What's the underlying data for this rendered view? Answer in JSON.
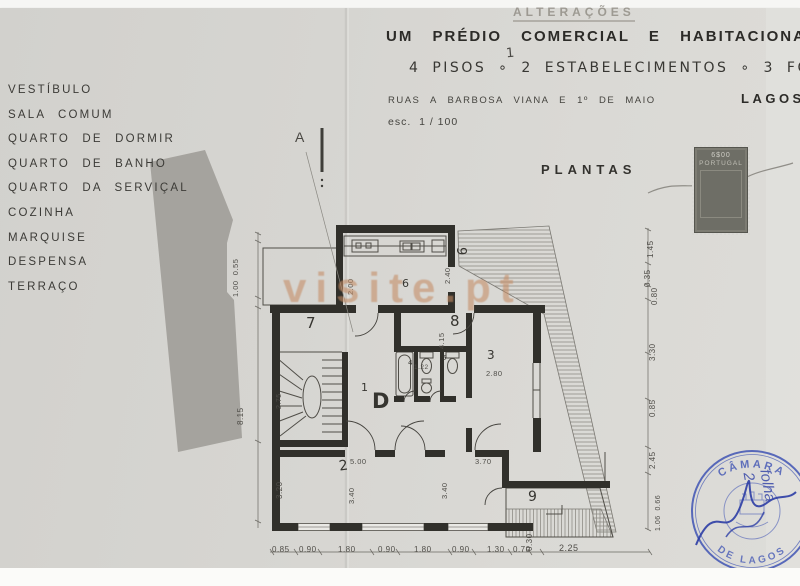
{
  "document": {
    "revision_note": "ALTERAÇÕES",
    "title": "UM PRÉDIO COMERCIAL E HABITACIONAL",
    "subtitle": "4 PISOS ∘ 2 ESTABELECIMENTOS ∘ 3 FOGOS",
    "handwritten_correction": "1",
    "address": "RUAS A BARBOSA VIANA E 1º DE MAIO",
    "city": "LAGOS",
    "scale": "esc.  1 / 100",
    "sheet_label": "PLANTAS"
  },
  "legend_rooms": [
    "VESTÍBULO",
    "SALA COMUM",
    "QUARTO DE DORMIR",
    "QUARTO DE BANHO",
    "QUARTO DA SERVIÇAL",
    "COZINHA",
    "MARQUISE",
    "DESPENSA",
    "TERRAÇO"
  ],
  "revenue_stamp": {
    "value": "6$00",
    "country": "PORTUGAL"
  },
  "municipal_stamp": {
    "arc_top": "CÂMARA",
    "arc_bottom": "DE LAGOS",
    "handwriting": "folha 2"
  },
  "watermark": "visite.pt",
  "plan": {
    "section_marker": "A",
    "room_numbers": [
      "7",
      "6",
      "8",
      "9",
      "3",
      "1",
      "D",
      "2",
      "9",
      "4",
      "5"
    ],
    "dims_bottom": [
      "0.85",
      "0.90",
      "1.80",
      "0.90",
      "1.80",
      "0.90",
      "1.30",
      "0.70",
      "0.30",
      "2.25"
    ],
    "dims_right": [
      "1.45",
      "0.35",
      "0.80",
      "3.30",
      "0.85",
      "2.45",
      "1.06  0.66"
    ],
    "dims_left": [
      "1.00  0.55",
      "8.15",
      "2.75",
      "3.20"
    ],
    "dims_inner": [
      "2.00",
      "2.40",
      "4.15",
      "2.80",
      "1.22",
      "5.00",
      "3.40",
      "3.70",
      "3.40"
    ]
  },
  "colors": {
    "stamp_blue": "#3f54b4",
    "watermark": "#c08a5e",
    "paper": "#d6d5d1"
  }
}
